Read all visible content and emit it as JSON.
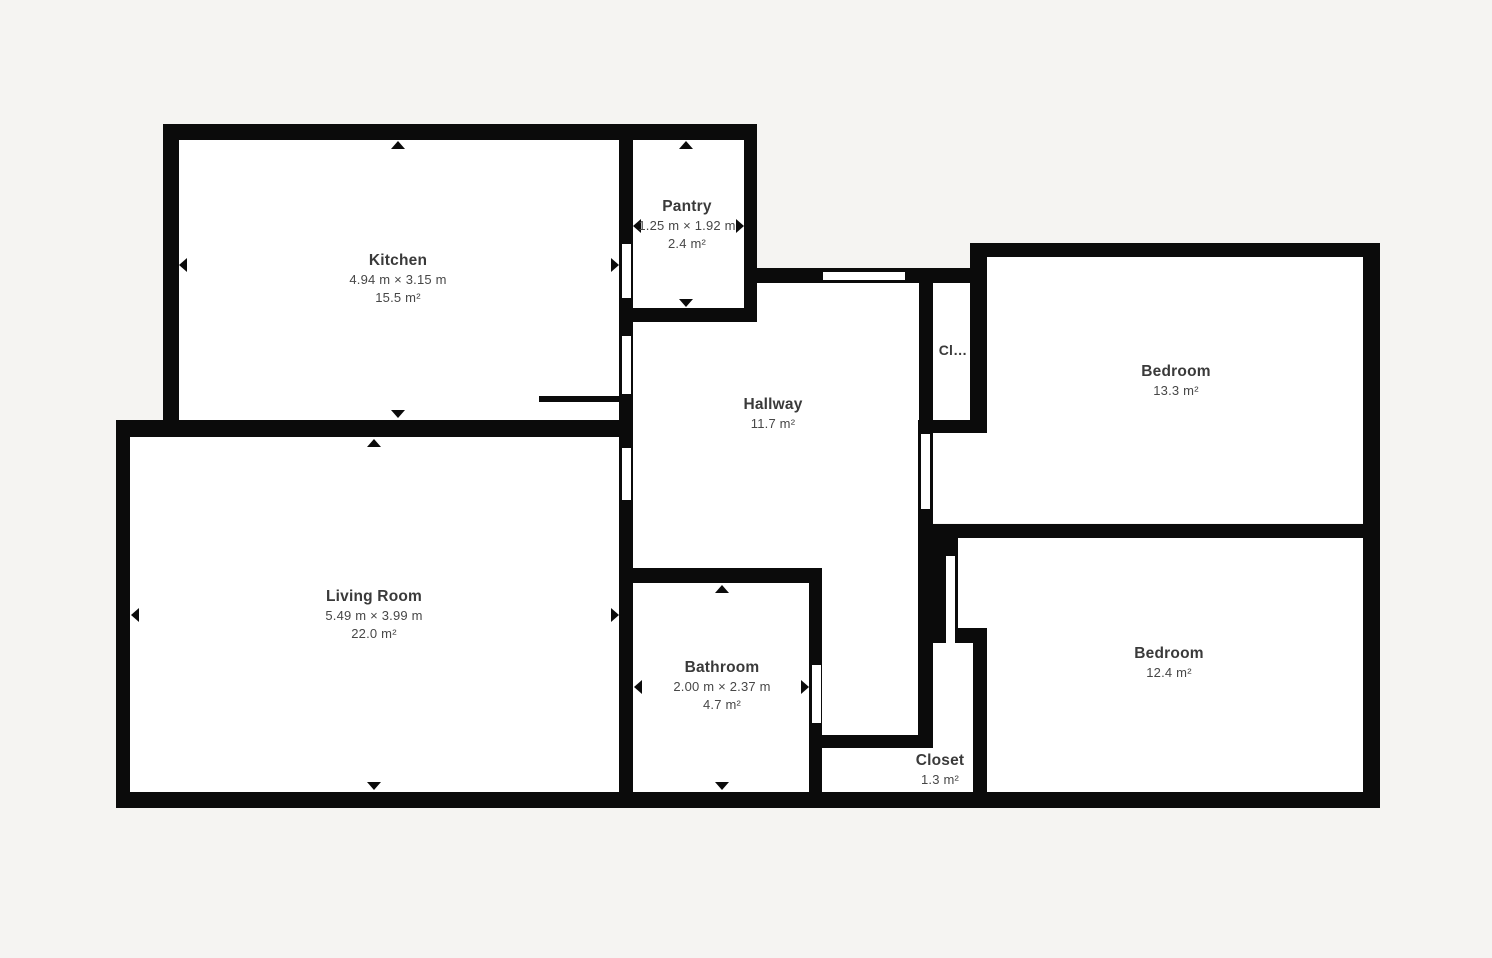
{
  "title": "Apartment floor plan",
  "colors": {
    "background": "#f5f4f2",
    "wall": "#0b0b0b",
    "floor": "#ffffff",
    "room_name": "#3a3a3a",
    "room_meta": "#474747"
  },
  "rooms": [
    {
      "name": "Kitchen",
      "dimensions": "4.94 m × 3.15 m",
      "area": "15.5 m²"
    },
    {
      "name": "Pantry",
      "dimensions": "1.25 m × 1.92 m",
      "area": "2.4 m²"
    },
    {
      "name": "Hallway",
      "area": "11.7 m²"
    },
    {
      "name": "Cl…"
    },
    {
      "name": "Bedroom",
      "area": "13.3 m²"
    },
    {
      "name": "Living Room",
      "dimensions": "5.49 m × 3.99 m",
      "area": "22.0 m²"
    },
    {
      "name": "Bathroom",
      "dimensions": "2.00 m × 2.37 m",
      "area": "4.7 m²"
    },
    {
      "name": "Closet",
      "area": "1.3 m²"
    },
    {
      "name": "Bedroom",
      "area": "12.4 m²"
    }
  ]
}
